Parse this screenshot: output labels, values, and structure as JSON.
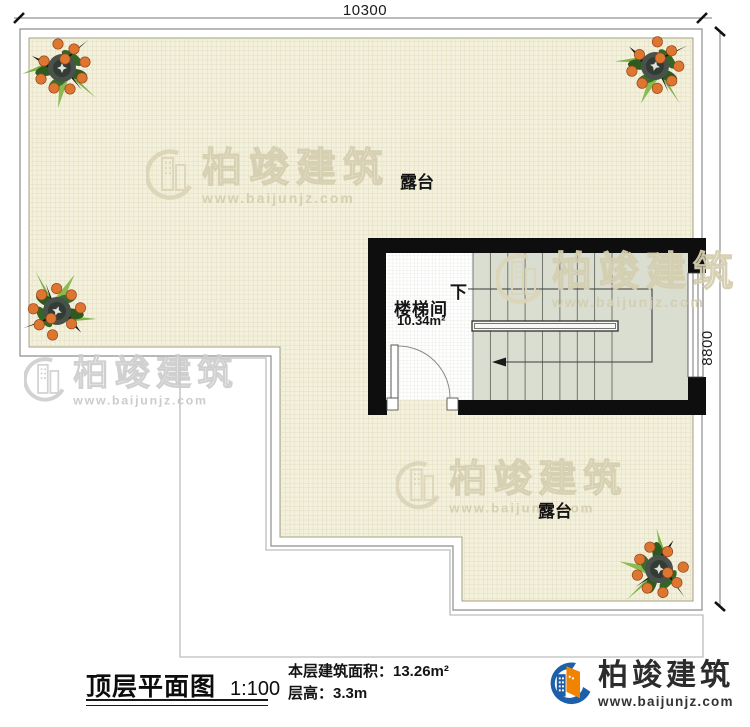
{
  "plan": {
    "dim_top": "10300",
    "dim_right": "8800",
    "terrace_label_top": "露台",
    "terrace_label_bottom": "露台",
    "stairwell_name": "楼梯间",
    "stairwell_area": "10.34m²",
    "stair_direction": "下"
  },
  "watermark": {
    "brand": "柏竣建筑",
    "url": "www.baijunjz.com"
  },
  "legend": {
    "title": "顶层平面图",
    "scale": "1:100",
    "area_line": "本层建筑面积：13.26m²",
    "height_line": "层高：3.3m"
  },
  "brand": {
    "name": "柏竣建筑",
    "url": "www.baijunjz.com"
  },
  "colors": {
    "terrace_fill": "#f3f0dc",
    "stair_fill": "#d9ded1",
    "wall": "#0e0e0e",
    "logo_blue": "#1d5fa8",
    "logo_orange": "#f08300"
  }
}
